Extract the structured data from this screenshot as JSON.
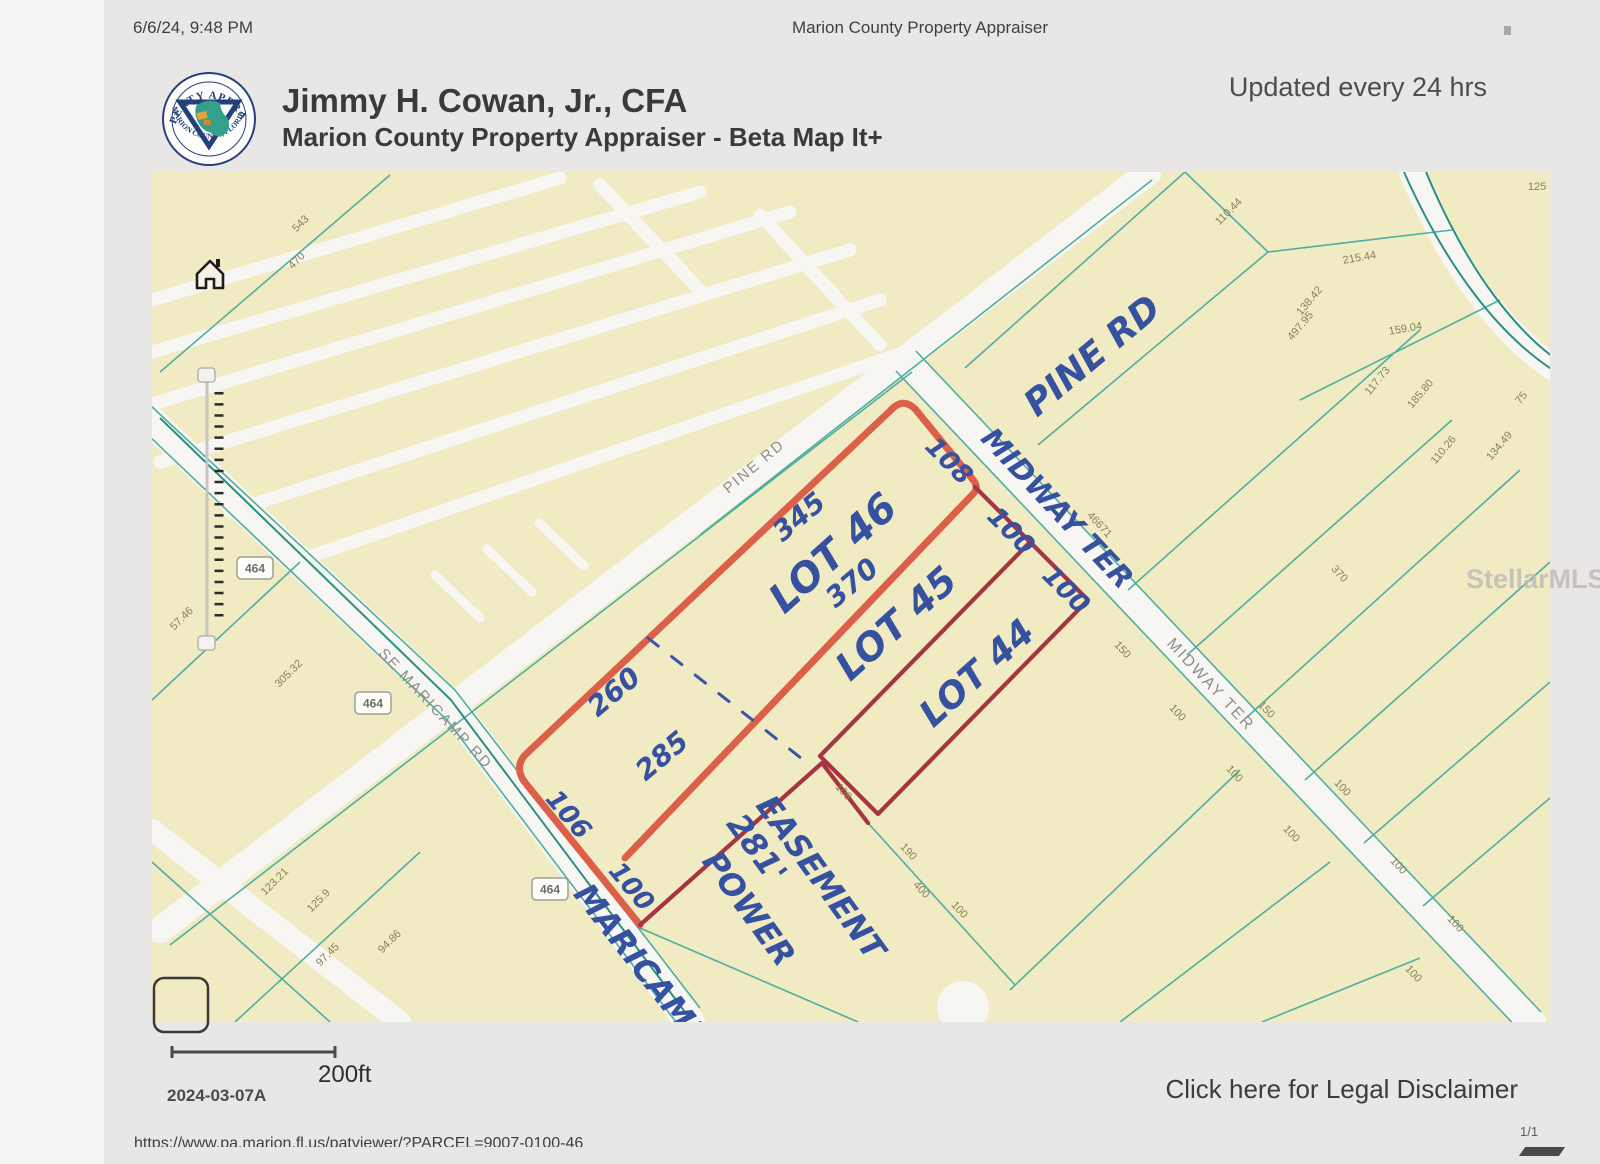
{
  "header": {
    "datetime": "6/6/24, 9:48 PM",
    "doc_title": "Marion County Property Appraiser",
    "updated": "Updated every 24 hrs"
  },
  "branding": {
    "appraiser_name": "Jimmy H. Cowan, Jr., CFA",
    "app_title": "Marion County Property Appraiser - Beta Map It+",
    "seal_top": "PROPERTY APPRAISER",
    "seal_bottom": "MARION COUNTY, FLORIDA"
  },
  "footer": {
    "scale_label": "200ft",
    "map_date": "2024-03-07A",
    "disclaimer": "Click here for Legal Disclaimer",
    "page_num": "1/1",
    "url": "https://www.pa.marion.fl.us/patviewer/?PARCEL=9007-0100-46",
    "watermark": "StellarMLS"
  },
  "map": {
    "colors": {
      "land": "#f0ebc3",
      "road": "#f8f6f2",
      "parcel_line": "#4fae9f",
      "highlight_primary": "#dc5f49",
      "highlight_secondary": "#a73441",
      "handwriting": "#35519f"
    },
    "handwritten": [
      {
        "t": "PINE RD",
        "x": 1100,
        "y": 365,
        "r": -40,
        "s": 36
      },
      {
        "t": "MIDWAY TER",
        "x": 1050,
        "y": 515,
        "r": 47,
        "s": 29
      },
      {
        "t": "LOT 46",
        "x": 842,
        "y": 563,
        "r": -42,
        "s": 40
      },
      {
        "t": "345",
        "x": 805,
        "y": 524,
        "r": -40,
        "s": 28
      },
      {
        "t": "370",
        "x": 858,
        "y": 590,
        "r": -40,
        "s": 28
      },
      {
        "t": "260",
        "x": 620,
        "y": 699,
        "r": -40,
        "s": 28
      },
      {
        "t": "285",
        "x": 668,
        "y": 763,
        "r": -40,
        "s": 28
      },
      {
        "t": "106",
        "x": 562,
        "y": 820,
        "r": 50,
        "s": 26
      },
      {
        "t": "100",
        "x": 625,
        "y": 892,
        "r": 50,
        "s": 26
      },
      {
        "t": "108",
        "x": 943,
        "y": 467,
        "r": 45,
        "s": 26
      },
      {
        "t": "100",
        "x": 1005,
        "y": 537,
        "r": 45,
        "s": 26
      },
      {
        "t": "100",
        "x": 1060,
        "y": 596,
        "r": 45,
        "s": 26
      },
      {
        "t": "LOT 45",
        "x": 905,
        "y": 633,
        "r": -42,
        "s": 38
      },
      {
        "t": "LOT 44",
        "x": 985,
        "y": 682,
        "r": -42,
        "s": 36
      },
      {
        "t": "281'",
        "x": 748,
        "y": 855,
        "r": 54,
        "s": 32
      },
      {
        "t": "POWER",
        "x": 740,
        "y": 915,
        "r": 54,
        "s": 32
      },
      {
        "t": "EASEMENT",
        "x": 812,
        "y": 884,
        "r": 54,
        "s": 32
      },
      {
        "t": "MARICAMP",
        "x": 633,
        "y": 972,
        "r": 52,
        "s": 32
      }
    ],
    "road_labels": [
      {
        "t": "PINE RD",
        "x": 757,
        "y": 470,
        "r": -40,
        "s": 15
      },
      {
        "t": "MIDWAY TER",
        "x": 1207,
        "y": 688,
        "r": 47,
        "s": 16
      },
      {
        "t": "SE MARICAMP RD",
        "x": 432,
        "y": 712,
        "r": 47,
        "s": 15
      }
    ],
    "shields": [
      {
        "t": "464",
        "x": 255,
        "y": 568
      },
      {
        "t": "464",
        "x": 373,
        "y": 703
      },
      {
        "t": "464",
        "x": 550,
        "y": 889
      }
    ],
    "parcel_labels": [
      {
        "t": "543",
        "x": 303,
        "y": 226,
        "r": -45
      },
      {
        "t": "470",
        "x": 299,
        "y": 263,
        "r": -45
      },
      {
        "t": "57.46",
        "x": 184,
        "y": 621,
        "r": -45
      },
      {
        "t": "305.32",
        "x": 291,
        "y": 676,
        "r": -45
      },
      {
        "t": "123.21",
        "x": 277,
        "y": 884,
        "r": -45
      },
      {
        "t": "125.9",
        "x": 321,
        "y": 903,
        "r": -45
      },
      {
        "t": "97.45",
        "x": 330,
        "y": 957,
        "r": -45
      },
      {
        "t": "94.86",
        "x": 392,
        "y": 944,
        "r": -45
      },
      {
        "t": "125",
        "x": 1537,
        "y": 190,
        "r": 0
      },
      {
        "t": "110.44",
        "x": 1231,
        "y": 214,
        "r": -45
      },
      {
        "t": "215.44",
        "x": 1360,
        "y": 261,
        "r": -10
      },
      {
        "t": "138.42",
        "x": 1312,
        "y": 303,
        "r": -50
      },
      {
        "t": "497.95",
        "x": 1303,
        "y": 328,
        "r": -50
      },
      {
        "t": "159.04",
        "x": 1406,
        "y": 332,
        "r": -10
      },
      {
        "t": "117.73",
        "x": 1380,
        "y": 383,
        "r": -50
      },
      {
        "t": "185.80",
        "x": 1423,
        "y": 396,
        "r": -50
      },
      {
        "t": "75",
        "x": 1524,
        "y": 400,
        "r": -50
      },
      {
        "t": "110.26",
        "x": 1446,
        "y": 452,
        "r": -50
      },
      {
        "t": "134.49",
        "x": 1502,
        "y": 448,
        "r": -50
      },
      {
        "t": "46671",
        "x": 1097,
        "y": 527,
        "r": 47
      },
      {
        "t": "370",
        "x": 1337,
        "y": 576,
        "r": 47
      },
      {
        "t": "150",
        "x": 1120,
        "y": 652,
        "r": 47
      },
      {
        "t": "150",
        "x": 1264,
        "y": 712,
        "r": 47
      },
      {
        "t": "100",
        "x": 1175,
        "y": 715,
        "r": 47
      },
      {
        "t": "100",
        "x": 1232,
        "y": 776,
        "r": 47
      },
      {
        "t": "100",
        "x": 1289,
        "y": 836,
        "r": 47
      },
      {
        "t": "100",
        "x": 1340,
        "y": 790,
        "r": 47
      },
      {
        "t": "108",
        "x": 841,
        "y": 794,
        "r": 47
      },
      {
        "t": "190",
        "x": 906,
        "y": 854,
        "r": 47
      },
      {
        "t": "400",
        "x": 919,
        "y": 892,
        "r": 47
      },
      {
        "t": "100",
        "x": 957,
        "y": 912,
        "r": 47
      },
      {
        "t": "100",
        "x": 1396,
        "y": 868,
        "r": 47
      },
      {
        "t": "100",
        "x": 1453,
        "y": 926,
        "r": 47
      },
      {
        "t": "100",
        "x": 1411,
        "y": 976,
        "r": 47
      }
    ]
  }
}
